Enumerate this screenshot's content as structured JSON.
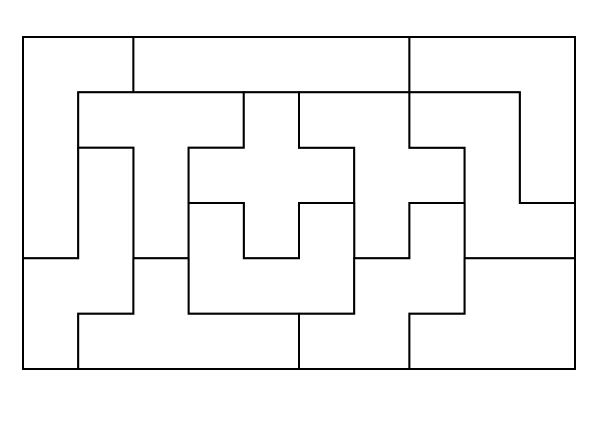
{
  "diagram": {
    "type": "pentomino-tiling",
    "canvas": {
      "width": 600,
      "height": 425
    },
    "board": {
      "x": 23,
      "y": 37,
      "width": 552,
      "height": 332,
      "cols": 10,
      "rows": 6,
      "cell_width": 55.2,
      "cell_height": 55.333
    },
    "style": {
      "background": "#ffffff",
      "line_color": "#000000",
      "line_width": 2,
      "fill": "#ffffff"
    },
    "pieces": [
      {
        "name": "L",
        "cells": [
          [
            0,
            0
          ],
          [
            0,
            1
          ],
          [
            1,
            0
          ],
          [
            2,
            0
          ],
          [
            3,
            0
          ]
        ],
        "outline": [
          [
            0,
            0
          ],
          [
            2,
            0
          ],
          [
            2,
            1
          ],
          [
            1,
            1
          ],
          [
            1,
            4
          ],
          [
            0,
            4
          ]
        ]
      },
      {
        "name": "I",
        "cells": [
          [
            0,
            2
          ],
          [
            0,
            3
          ],
          [
            0,
            4
          ],
          [
            0,
            5
          ],
          [
            0,
            6
          ]
        ],
        "outline": [
          [
            2,
            0
          ],
          [
            7,
            0
          ],
          [
            7,
            1
          ],
          [
            2,
            1
          ]
        ]
      },
      {
        "name": "V",
        "cells": [
          [
            0,
            7
          ],
          [
            0,
            8
          ],
          [
            0,
            9
          ],
          [
            1,
            9
          ],
          [
            2,
            9
          ]
        ],
        "outline": [
          [
            7,
            0
          ],
          [
            10,
            0
          ],
          [
            10,
            3
          ],
          [
            9,
            3
          ],
          [
            9,
            1
          ],
          [
            7,
            1
          ]
        ]
      },
      {
        "name": "T",
        "cells": [
          [
            1,
            1
          ],
          [
            1,
            2
          ],
          [
            1,
            3
          ],
          [
            2,
            2
          ],
          [
            3,
            2
          ]
        ],
        "outline": [
          [
            1,
            1
          ],
          [
            4,
            1
          ],
          [
            4,
            2
          ],
          [
            3,
            2
          ],
          [
            3,
            4
          ],
          [
            2,
            4
          ],
          [
            2,
            2
          ],
          [
            1,
            2
          ]
        ]
      },
      {
        "name": "X",
        "cells": [
          [
            1,
            4
          ],
          [
            2,
            3
          ],
          [
            2,
            4
          ],
          [
            2,
            5
          ],
          [
            3,
            4
          ]
        ],
        "outline": [
          [
            4,
            1
          ],
          [
            5,
            1
          ],
          [
            5,
            2
          ],
          [
            6,
            2
          ],
          [
            6,
            3
          ],
          [
            5,
            3
          ],
          [
            5,
            4
          ],
          [
            4,
            4
          ],
          [
            4,
            3
          ],
          [
            3,
            3
          ],
          [
            3,
            2
          ],
          [
            4,
            2
          ]
        ]
      },
      {
        "name": "F",
        "cells": [
          [
            1,
            5
          ],
          [
            1,
            6
          ],
          [
            2,
            6
          ],
          [
            2,
            7
          ],
          [
            3,
            6
          ]
        ],
        "outline": [
          [
            5,
            1
          ],
          [
            7,
            1
          ],
          [
            7,
            2
          ],
          [
            8,
            2
          ],
          [
            8,
            3
          ],
          [
            7,
            3
          ],
          [
            7,
            4
          ],
          [
            6,
            4
          ],
          [
            6,
            2
          ],
          [
            5,
            2
          ]
        ]
      },
      {
        "name": "Z",
        "cells": [
          [
            1,
            7
          ],
          [
            1,
            8
          ],
          [
            2,
            8
          ],
          [
            3,
            8
          ],
          [
            3,
            9
          ]
        ],
        "outline": [
          [
            7,
            1
          ],
          [
            9,
            1
          ],
          [
            9,
            3
          ],
          [
            10,
            3
          ],
          [
            10,
            4
          ],
          [
            8,
            4
          ],
          [
            8,
            2
          ],
          [
            7,
            2
          ]
        ]
      },
      {
        "name": "N",
        "cells": [
          [
            2,
            1
          ],
          [
            3,
            1
          ],
          [
            4,
            0
          ],
          [
            4,
            1
          ],
          [
            5,
            0
          ]
        ],
        "outline": [
          [
            1,
            2
          ],
          [
            2,
            2
          ],
          [
            2,
            5
          ],
          [
            1,
            5
          ],
          [
            1,
            6
          ],
          [
            0,
            6
          ],
          [
            0,
            4
          ],
          [
            1,
            4
          ]
        ]
      },
      {
        "name": "U",
        "cells": [
          [
            3,
            3
          ],
          [
            3,
            5
          ],
          [
            4,
            3
          ],
          [
            4,
            4
          ],
          [
            4,
            5
          ]
        ],
        "outline": [
          [
            3,
            3
          ],
          [
            4,
            3
          ],
          [
            4,
            4
          ],
          [
            5,
            4
          ],
          [
            5,
            3
          ],
          [
            6,
            3
          ],
          [
            6,
            5
          ],
          [
            3,
            5
          ]
        ]
      },
      {
        "name": "W",
        "cells": [
          [
            3,
            7
          ],
          [
            4,
            6
          ],
          [
            4,
            7
          ],
          [
            5,
            5
          ],
          [
            5,
            6
          ]
        ],
        "outline": [
          [
            7,
            3
          ],
          [
            8,
            3
          ],
          [
            8,
            5
          ],
          [
            7,
            5
          ],
          [
            7,
            6
          ],
          [
            5,
            6
          ],
          [
            5,
            5
          ],
          [
            6,
            5
          ],
          [
            6,
            4
          ],
          [
            7,
            4
          ]
        ]
      },
      {
        "name": "Y",
        "cells": [
          [
            4,
            2
          ],
          [
            5,
            1
          ],
          [
            5,
            2
          ],
          [
            5,
            3
          ],
          [
            5,
            4
          ]
        ],
        "outline": [
          [
            2,
            4
          ],
          [
            3,
            4
          ],
          [
            3,
            5
          ],
          [
            5,
            5
          ],
          [
            5,
            6
          ],
          [
            1,
            6
          ],
          [
            1,
            5
          ],
          [
            2,
            5
          ]
        ]
      },
      {
        "name": "P",
        "cells": [
          [
            4,
            8
          ],
          [
            4,
            9
          ],
          [
            5,
            7
          ],
          [
            5,
            8
          ],
          [
            5,
            9
          ]
        ],
        "outline": [
          [
            8,
            4
          ],
          [
            10,
            4
          ],
          [
            10,
            6
          ],
          [
            7,
            6
          ],
          [
            7,
            5
          ],
          [
            8,
            5
          ]
        ]
      }
    ]
  }
}
